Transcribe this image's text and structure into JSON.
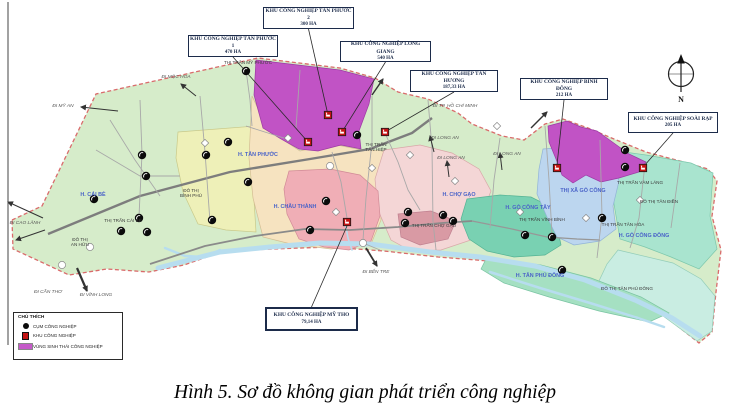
{
  "figure": {
    "caption": "Hình 5. Sơ đồ không gian phát triển công nghiệp"
  },
  "compass": {
    "label": "N"
  },
  "legend": {
    "title": "CHÚ THÍCH",
    "items": [
      {
        "icon": "industrial-cluster-marker-icon",
        "shape": "circle",
        "color": "#0b0b0b",
        "label": "CỤM CÔNG NGHIỆP"
      },
      {
        "icon": "industrial-zone-marker-icon",
        "shape": "square",
        "color": "#c41414",
        "label": "KHU CÔNG NGHIỆP"
      },
      {
        "icon": "eco-industrial-area-swatch",
        "shape": "rect",
        "color": "#c55ac9",
        "label": "VÙNG SINH THÁI CÔNG NGHIỆP"
      }
    ]
  },
  "callouts": [
    {
      "id": "kcn-tan-phuoc-1",
      "name": "KHU CÔNG NGHIỆP TÂN PHƯỚC 1",
      "area": "470 HA",
      "box": [
        188,
        35,
        90,
        22
      ],
      "anchor": [
        308,
        142
      ],
      "attach": "bottom",
      "thick": false
    },
    {
      "id": "kcn-tan-phuoc-2",
      "name": "KHU CÔNG NGHIỆP TÂN PHƯỚC 2",
      "area": "300 HA",
      "box": [
        263,
        7,
        91,
        22
      ],
      "anchor": [
        328,
        115
      ],
      "attach": "bottom",
      "thick": false
    },
    {
      "id": "kcn-long-giang",
      "name": "KHU CÔNG NGHIỆP LONG GIANG",
      "area": "540 HA",
      "box": [
        340,
        41,
        91,
        21
      ],
      "anchor": [
        342,
        132
      ],
      "attach": "bottom",
      "thick": false
    },
    {
      "id": "kcn-tan-huong",
      "name": "KHU CÔNG NGHIỆP TÂN HƯƠNG",
      "area": "187,33 HA",
      "box": [
        410,
        70,
        88,
        22
      ],
      "anchor": [
        385,
        132
      ],
      "attach": "bottom",
      "thick": false
    },
    {
      "id": "kcn-binh-dong",
      "name": "KHU CÔNG NGHIỆP BÌNH ĐÔNG",
      "area": "212 HA",
      "box": [
        520,
        78,
        88,
        22
      ],
      "anchor": [
        557,
        165
      ],
      "attach": "bottom",
      "thick": false
    },
    {
      "id": "kcn-soai-rap",
      "name": "KHU CÔNG NGHIỆP SOÀI RẠP",
      "area": "205 HA",
      "box": [
        628,
        112,
        90,
        21
      ],
      "anchor": [
        644,
        166
      ],
      "attach": "bottom",
      "thick": false
    },
    {
      "id": "kcn-my-tho",
      "name": "KHU CÔNG NGHIỆP MỸ THO",
      "area": "79,14 HA",
      "box": [
        265,
        307,
        93,
        24
      ],
      "anchor": [
        347,
        226
      ],
      "attach": "top",
      "thick": true
    }
  ],
  "map": {
    "palette": {
      "river": "#b7ddef",
      "outline_border": "#d96b6b",
      "leader": "#2a2a2a",
      "arrow": "#333333",
      "zone_marker": "#c41414",
      "cluster_marker": "#0b0b0b"
    },
    "outline": {
      "id": "tien-giang-province",
      "fill": "#d6ecca",
      "points": "12,220 42,206 96,94 258,58 340,68 375,78 398,92 428,99 458,113 472,124 502,136 524,140 545,124 563,119 588,128 614,139 646,152 680,161 708,169 717,181 712,216 721,250 716,292 712,332 699,343 666,317 629,297 584,281 539,269 489,261 438,257 384,251 329,247 274,249 224,251 184,265 149,272 107,269 69,275 39,261 13,249"
    },
    "regions": [
      {
        "id": "cai-lay-yellow",
        "fill": "#eef0b8",
        "stroke": "#c9c98a",
        "points": "178,132 256,126 252,168 256,232 226,230 198,224 183,192 176,158"
      },
      {
        "id": "chau-thanh-cream",
        "fill": "#f6e3c0",
        "stroke": "#d4bd93",
        "points": "252,96 268,130 300,151 332,144 362,150 386,151 379,186 381,220 371,244 331,249 291,244 263,237 253,198 249,158"
      },
      {
        "id": "cho-gao-pink",
        "fill": "#f4d6d6",
        "stroke": "#d8a8a8",
        "points": "384,150 420,145 452,153 479,169 491,191 481,216 471,240 441,250 411,251 391,240 378,210 375,179"
      },
      {
        "id": "cho-gao-dark-rose",
        "fill": "#d99aa4",
        "stroke": "#c08090",
        "points": "398,214 431,211 456,221 448,239 420,245 401,237"
      },
      {
        "id": "my-tho-pink",
        "fill": "#f0aeb6",
        "stroke": "#d18a96",
        "points": "289,171 330,169 360,175 378,191 380,216 371,241 349,250 324,247 299,239 287,214 284,189"
      },
      {
        "id": "go-cong-tay-teal",
        "fill": "#79d1b2",
        "stroke": "#55b394",
        "points": "467,199 500,195 531,197 549,206 557,226 561,245 545,255 514,257 487,251 469,239 461,219"
      },
      {
        "id": "go-cong-dong-mint",
        "fill": "#a9e4cf",
        "stroke": "#7cc7ac",
        "points": "589,147 646,155 691,163 713,173 710,216 717,249 699,269 671,257 645,247 620,239 614,204 611,169"
      },
      {
        "id": "go-cong-dong-tail",
        "fill": "#c9ede2",
        "stroke": "#93cdb9",
        "points": "618,250 673,263 701,279 715,296 712,331 697,341 663,316 627,295 599,281 607,264"
      },
      {
        "id": "tan-phu-dong-island",
        "fill": "#a5e0c2",
        "stroke": "#79c4a2",
        "points": "487,257 541,265 591,278 641,297 669,313 649,322 599,311 549,297 504,283 481,269"
      },
      {
        "id": "tx-go-cong-blue",
        "fill": "#bcd6ef",
        "stroke": "#92b4d8",
        "points": "543,149 570,147 591,155 613,163 619,181 613,206 616,229 600,241 574,245 557,237 547,217 537,194 539,169"
      },
      {
        "id": "eco-zone-tan-phuoc-purple",
        "fill": "#c153c5",
        "stroke": "#9c3ba3",
        "points": "256,60 340,70 374,79 369,104 359,131 361,149 341,145 318,151 299,149 281,139 263,128 254,95"
      },
      {
        "id": "eco-zone-go-cong-purple",
        "fill": "#c153c5",
        "stroke": "#9c3ba3",
        "points": "548,126 567,121 581,127 597,131 611,141 629,154 646,162 639,172 619,178 601,182 586,175 573,183 562,175 556,159 549,142"
      }
    ],
    "rivers": [
      {
        "points": "158,268 220,252 270,247 320,243 370,244 430,252 480,257 535,266 585,280 635,300 672,318 700,336",
        "w": 5
      },
      {
        "points": "490,272 540,288 590,303 638,318 664,327",
        "w": 2.5
      },
      {
        "points": "165,248 185,256 205,257 220,250",
        "w": 2.5
      },
      {
        "points": "345,222 348,238 352,250",
        "w": 1.6
      }
    ],
    "roads": [
      {
        "points": "48,234 140,196 230,172 310,159 370,149 412,133 432,118",
        "w": 2.4,
        "c": "#7d7d7d"
      },
      {
        "points": "150,264 205,246 255,236 305,229 350,230 398,227 442,223 472,221",
        "w": 1.8,
        "c": "#8a8a8a"
      },
      {
        "points": "472,221 512,229 547,237 577,239 600,240",
        "w": 1.2,
        "c": "#979797"
      },
      {
        "points": "246,70 250,100 252,126",
        "w": 0.9,
        "c": "#a8a8a8"
      },
      {
        "points": "200,96 205,152 210,222",
        "w": 0.9,
        "c": "#a8a8a8"
      },
      {
        "points": "300,70 296,128",
        "w": 0.9,
        "c": "#a8a8a8"
      },
      {
        "points": "372,96 372,142 366,198 363,240",
        "w": 0.9,
        "c": "#a8a8a8"
      },
      {
        "points": "428,100 432,148 433,222 436,250",
        "w": 0.9,
        "c": "#a8a8a8"
      },
      {
        "points": "332,152 341,182 347,218",
        "w": 0.9,
        "c": "#a8a8a8"
      },
      {
        "points": "500,138 494,180 490,228",
        "w": 0.9,
        "c": "#a8a8a8"
      },
      {
        "points": "545,126 549,180 552,235",
        "w": 0.9,
        "c": "#a8a8a8"
      },
      {
        "points": "600,140 602,216 597,258",
        "w": 0.9,
        "c": "#a8a8a8"
      },
      {
        "points": "645,164 639,218 630,248",
        "w": 0.9,
        "c": "#a8a8a8"
      },
      {
        "points": "680,163 671,228",
        "w": 0.9,
        "c": "#a8a8a8"
      },
      {
        "points": "140,100 142,154 139,216",
        "w": 0.9,
        "c": "#a8a8a8"
      },
      {
        "points": "96,150 140,176 180,176",
        "w": 0.9,
        "c": "#a8a8a8"
      },
      {
        "points": "110,120 135,160 160,196",
        "w": 0.9,
        "c": "#a8a8a8"
      },
      {
        "points": "385,133 398,162 408,190 420,210",
        "w": 0.9,
        "c": "#a8a8a8"
      },
      {
        "points": "246,126 290,140",
        "w": 0.9,
        "c": "#a8a8a8"
      },
      {
        "points": "363,243 380,250",
        "w": 0.9,
        "c": "#a8a8a8"
      }
    ],
    "district_labels": [
      {
        "text": "H. CÁI BÈ",
        "x": 93,
        "y": 196
      },
      {
        "text": "H. TÂN PHƯỚC",
        "x": 258,
        "y": 156
      },
      {
        "text": "H. CHÂU THÀNH",
        "x": 295,
        "y": 208
      },
      {
        "text": "H. CHỢ GẠO",
        "x": 459,
        "y": 196
      },
      {
        "text": "H. GÒ CÔNG TÂY",
        "x": 528,
        "y": 209
      },
      {
        "text": "THỊ XÃ GÒ CÔNG",
        "x": 583,
        "y": 192
      },
      {
        "text": "H. GÒ CÔNG ĐÔNG",
        "x": 644,
        "y": 237
      },
      {
        "text": "H. TÂN PHÚ ĐÔNG",
        "x": 540,
        "y": 277
      }
    ],
    "town_labels": [
      {
        "text": "THỊ TRẤN MỸ PHƯỚC",
        "x": 248,
        "y": 64
      },
      {
        "text": "THỊ TRẤN\nTÂN HIỆP",
        "x": 376,
        "y": 146
      },
      {
        "text": "THỊ TRẤN CÁI BÈ",
        "x": 123,
        "y": 222
      },
      {
        "text": "ĐÔ THỊ\nAN HỮU",
        "x": 80,
        "y": 241
      },
      {
        "text": "ĐÔ THỊ\nBÌNH PHÚ",
        "x": 191,
        "y": 192
      },
      {
        "text": "THỊ TRẤN CHỢ GẠO",
        "x": 434,
        "y": 227
      },
      {
        "text": "THỊ TRẤN VĨNH BÌNH",
        "x": 542,
        "y": 221
      },
      {
        "text": "THỊ TRẤN VÀM LÁNG",
        "x": 640,
        "y": 184
      },
      {
        "text": "ĐÔ THỊ TÂN ĐIỀN",
        "x": 659,
        "y": 203
      },
      {
        "text": "THỊ TRẤN TÂN HÒA",
        "x": 623,
        "y": 226
      },
      {
        "text": "ĐÔ THỊ TÂN PHÚ ĐÔNG",
        "x": 627,
        "y": 290
      }
    ],
    "direction_labels": [
      {
        "text": "ĐI MỘC HÓA",
        "x": 176,
        "y": 78
      },
      {
        "text": "ĐI MỸ AN",
        "x": 63,
        "y": 107
      },
      {
        "text": "ĐI CAO LÃNH",
        "x": 25,
        "y": 224
      },
      {
        "text": "ĐI CẦN THƠ",
        "x": 48,
        "y": 293
      },
      {
        "text": "ĐI VĨNH LONG",
        "x": 96,
        "y": 296
      },
      {
        "text": "ĐI BẾN TRE",
        "x": 376,
        "y": 273
      },
      {
        "text": "ĐI TP. HỒ CHÍ MINH",
        "x": 455,
        "y": 107
      },
      {
        "text": "ĐI LONG AN",
        "x": 445,
        "y": 139
      },
      {
        "text": "ĐI LONG AN",
        "x": 451,
        "y": 159
      },
      {
        "text": "ĐI LONG AN",
        "x": 507,
        "y": 155
      }
    ],
    "cluster_markers": [
      [
        246,
        71
      ],
      [
        142,
        155
      ],
      [
        146,
        176
      ],
      [
        228,
        142
      ],
      [
        206,
        155
      ],
      [
        94,
        199
      ],
      [
        139,
        218
      ],
      [
        121,
        231
      ],
      [
        147,
        232
      ],
      [
        248,
        182
      ],
      [
        212,
        220
      ],
      [
        357,
        135
      ],
      [
        326,
        201
      ],
      [
        310,
        230
      ],
      [
        408,
        212
      ],
      [
        443,
        215
      ],
      [
        453,
        221
      ],
      [
        405,
        223
      ],
      [
        525,
        235
      ],
      [
        552,
        237
      ],
      [
        625,
        150
      ],
      [
        625,
        167
      ],
      [
        602,
        218
      ],
      [
        562,
        270
      ]
    ],
    "zone_markers": [
      [
        328,
        115
      ],
      [
        342,
        132
      ],
      [
        308,
        142
      ],
      [
        385,
        132
      ],
      [
        347,
        222
      ],
      [
        557,
        168
      ],
      [
        643,
        168
      ]
    ],
    "shields": {
      "diamonds": [
        [
          205,
          143
        ],
        [
          288,
          138
        ],
        [
          336,
          212
        ],
        [
          410,
          155
        ],
        [
          455,
          181
        ],
        [
          497,
          126
        ],
        [
          520,
          212
        ],
        [
          586,
          218
        ],
        [
          640,
          200
        ],
        [
          372,
          168
        ]
      ],
      "circles": [
        [
          62,
          265
        ],
        [
          363,
          243
        ],
        [
          90,
          247
        ],
        [
          330,
          166
        ]
      ]
    },
    "arrows": [
      {
        "from": [
          118,
          111
        ],
        "to": [
          81,
          107
        ],
        "w": 1
      },
      {
        "from": [
          196,
          96
        ],
        "to": [
          181,
          84
        ],
        "w": 1
      },
      {
        "from": [
          45,
          230
        ],
        "to": [
          16,
          240
        ],
        "w": 1
      },
      {
        "from": [
          43,
          218
        ],
        "to": [
          8,
          202
        ],
        "w": 1
      },
      {
        "from": [
          77,
          268
        ],
        "to": [
          87,
          291
        ],
        "w": 2.2
      },
      {
        "from": [
          366,
          248
        ],
        "to": [
          377,
          266
        ],
        "w": 1.8
      },
      {
        "from": [
          372,
          95
        ],
        "to": [
          383,
          79
        ],
        "w": 1.4
      },
      {
        "from": [
          531,
          128
        ],
        "to": [
          547,
          112
        ],
        "w": 1.4
      },
      {
        "from": [
          434,
          152
        ],
        "to": [
          430,
          136
        ],
        "w": 1
      },
      {
        "from": [
          449,
          177
        ],
        "to": [
          447,
          161
        ],
        "w": 1
      },
      {
        "from": [
          502,
          170
        ],
        "to": [
          500,
          153
        ],
        "w": 1
      }
    ]
  }
}
